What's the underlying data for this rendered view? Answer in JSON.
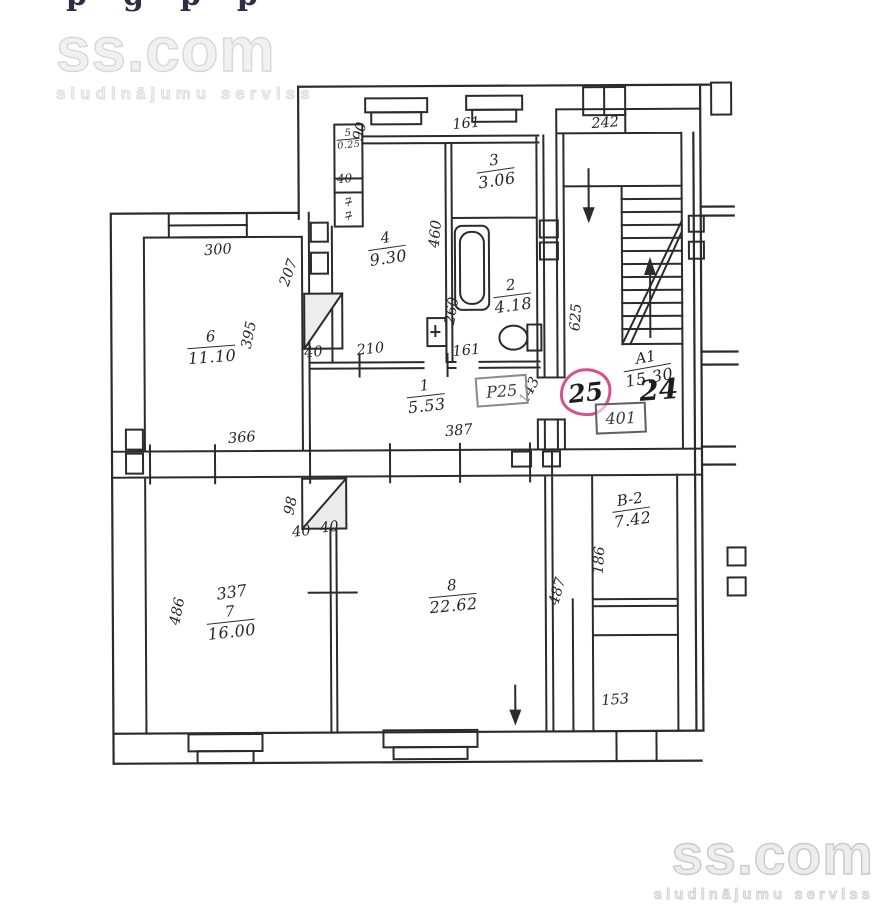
{
  "page": {
    "edge_fragment": "pgpp",
    "watermark": {
      "brand": "ss.com",
      "tagline": "sludinājumu serviss"
    }
  },
  "plan": {
    "rooms": {
      "r5": {
        "num": "5",
        "area": "0.25"
      },
      "r3": {
        "num": "3",
        "area": "3.06"
      },
      "r4": {
        "num": "4",
        "area": "9.30"
      },
      "r2": {
        "num": "2",
        "area": "4.18"
      },
      "r6": {
        "num": "6",
        "area": "11.10"
      },
      "r1": {
        "num": "1",
        "area": "5.53"
      },
      "a1": {
        "num": "A1",
        "area": "15.30"
      },
      "b2": {
        "num": "B-2",
        "area": "7.42"
      },
      "r7": {
        "num": "7",
        "area": "16.00"
      },
      "r8": {
        "num": "8",
        "area": "22.62"
      }
    },
    "dims": {
      "d90": "90",
      "d40_closet": "40",
      "d161_top": "161",
      "d460": "460",
      "d260": "260",
      "d300": "300",
      "d207": "207",
      "d395": "395",
      "d40_upper": "40",
      "d366": "366",
      "d210": "210",
      "d161_bath": "161",
      "d387": "387",
      "d143": "143",
      "d242": "242",
      "d625": "625",
      "d98": "98",
      "d40_a": "40",
      "d40_b": "40",
      "d337": "337",
      "d486": "486",
      "d487": "487",
      "d186": "186",
      "d153": "153"
    },
    "flue_marks": {
      "a": "7",
      "b": "7"
    },
    "apartment": {
      "circled": "25",
      "neighbor": "24"
    },
    "stamps": {
      "entry": "P25",
      "landing": "401"
    }
  },
  "colors": {
    "ink": "#2b2b2b",
    "highlight_circle": "#d6528c",
    "stamp_border": "#8a8a8a",
    "watermark": "#d7d7d7"
  }
}
